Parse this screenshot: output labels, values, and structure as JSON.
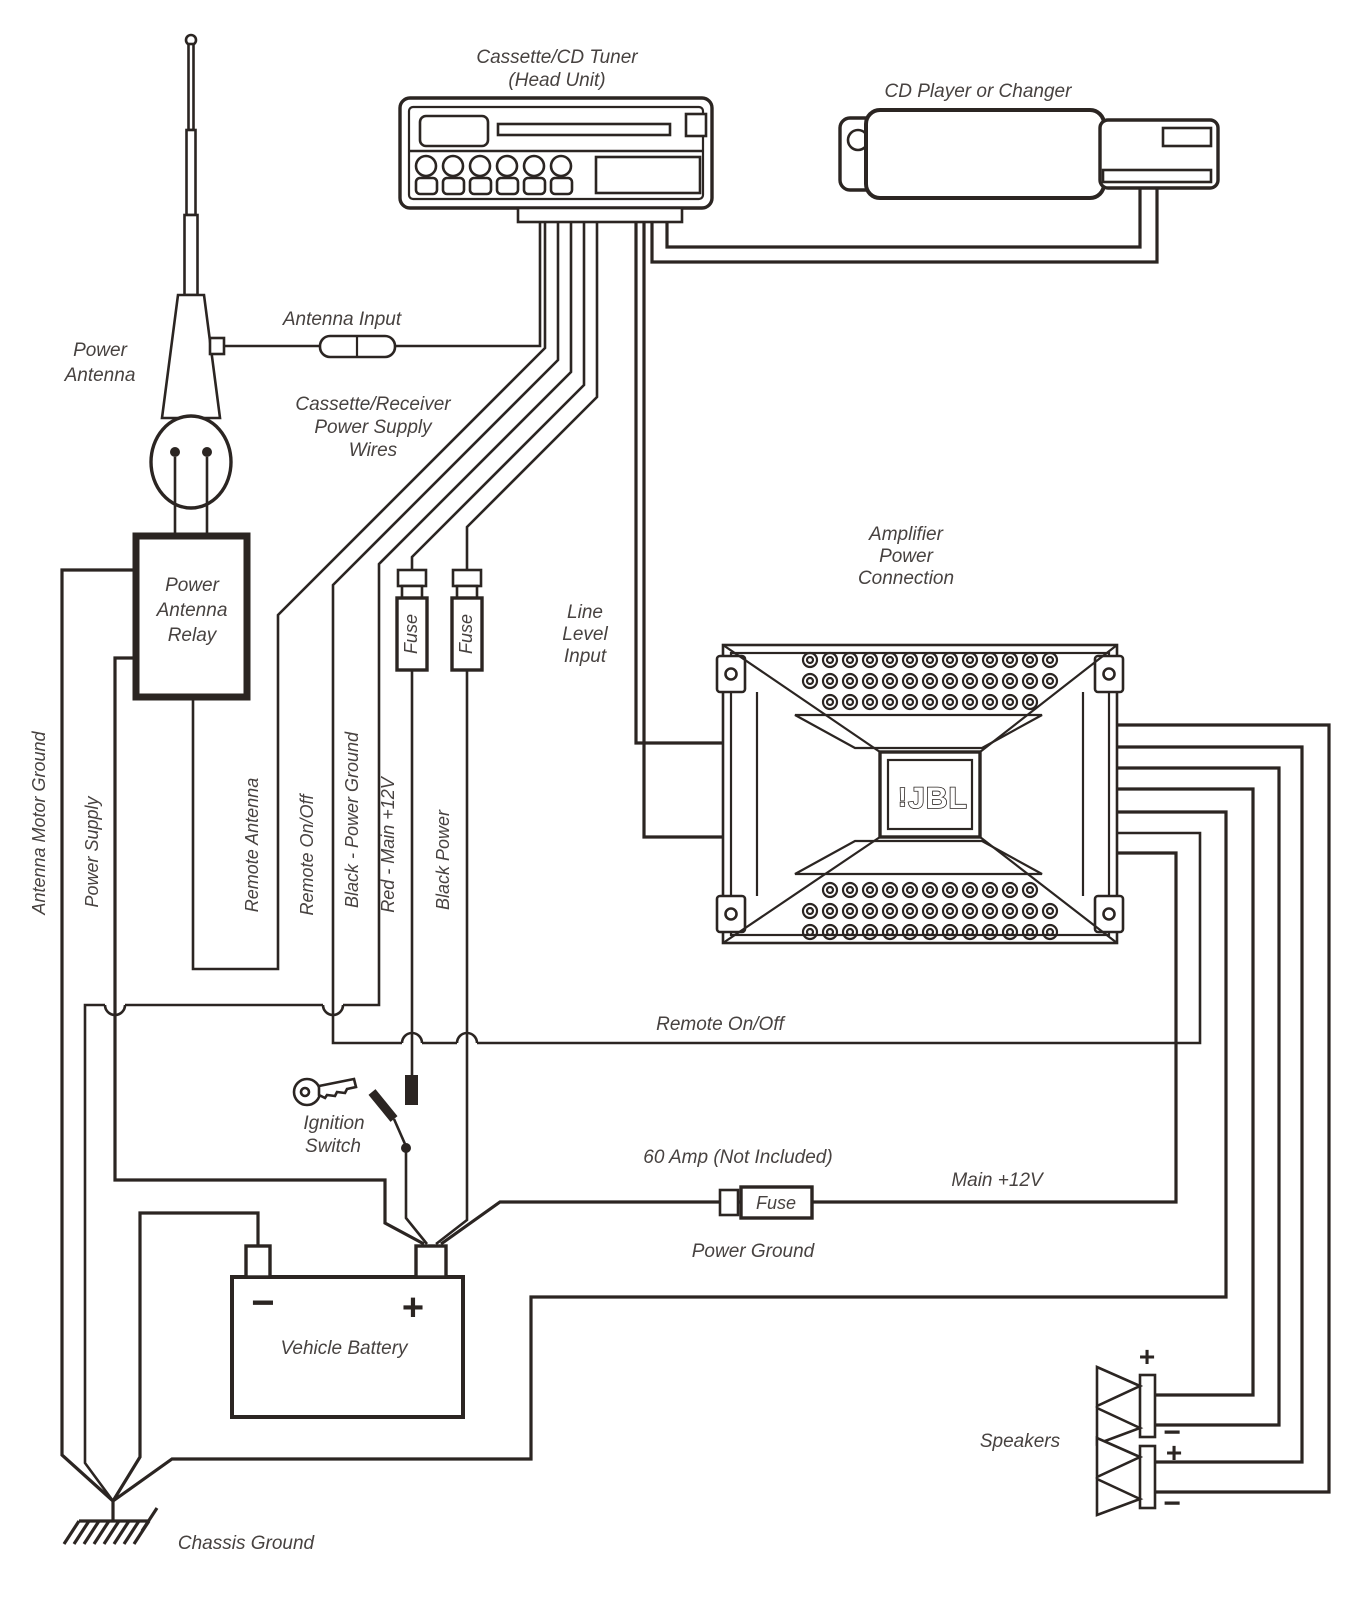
{
  "colors": {
    "ink": "#2b2522",
    "background": "#ffffff",
    "text": "#474240"
  },
  "head_unit": {
    "label": [
      "Cassette/CD Tuner",
      "(Head Unit)"
    ]
  },
  "cd_player": {
    "label": "CD Player or Changer"
  },
  "power_antenna": {
    "label": [
      "Power",
      "Antenna"
    ]
  },
  "antenna_input": {
    "label": "Antenna Input"
  },
  "supply_wires_note": {
    "label": [
      "Cassette/Receiver",
      "Power Supply",
      "Wires"
    ]
  },
  "relay": {
    "label": [
      "Power",
      "Antenna",
      "Relay"
    ]
  },
  "amplifier": {
    "label": [
      "Amplifier",
      "Power",
      "Connection"
    ],
    "logo_mark": "!",
    "logo": "JBL"
  },
  "line_level": {
    "label": [
      "Line",
      "Level",
      "Input"
    ]
  },
  "wire_labels": {
    "antenna_motor_ground": "Antenna Motor Ground",
    "power_supply": "Power Supply",
    "remote_antenna": "Remote Antenna",
    "remote_on_off": "Remote On/Off",
    "black_power_ground": "Black - Power Ground",
    "red_main_12v": "Red - Main +12V",
    "black_power": "Black Power"
  },
  "fuse": {
    "label": "Fuse"
  },
  "run_labels": {
    "remote_on_off": "Remote On/Off",
    "fuse_note": "60 Amp (Not Included)",
    "main_12v": "Main +12V",
    "power_ground": "Power Ground"
  },
  "ignition": {
    "label": [
      "Ignition",
      "Switch"
    ]
  },
  "battery": {
    "label": "Vehicle Battery",
    "minus": "−",
    "plus": "+"
  },
  "speakers": {
    "label": "Speakers",
    "terminals": [
      "+",
      "−",
      "+",
      "−"
    ]
  },
  "chassis_ground": {
    "label": "Chassis Ground"
  }
}
